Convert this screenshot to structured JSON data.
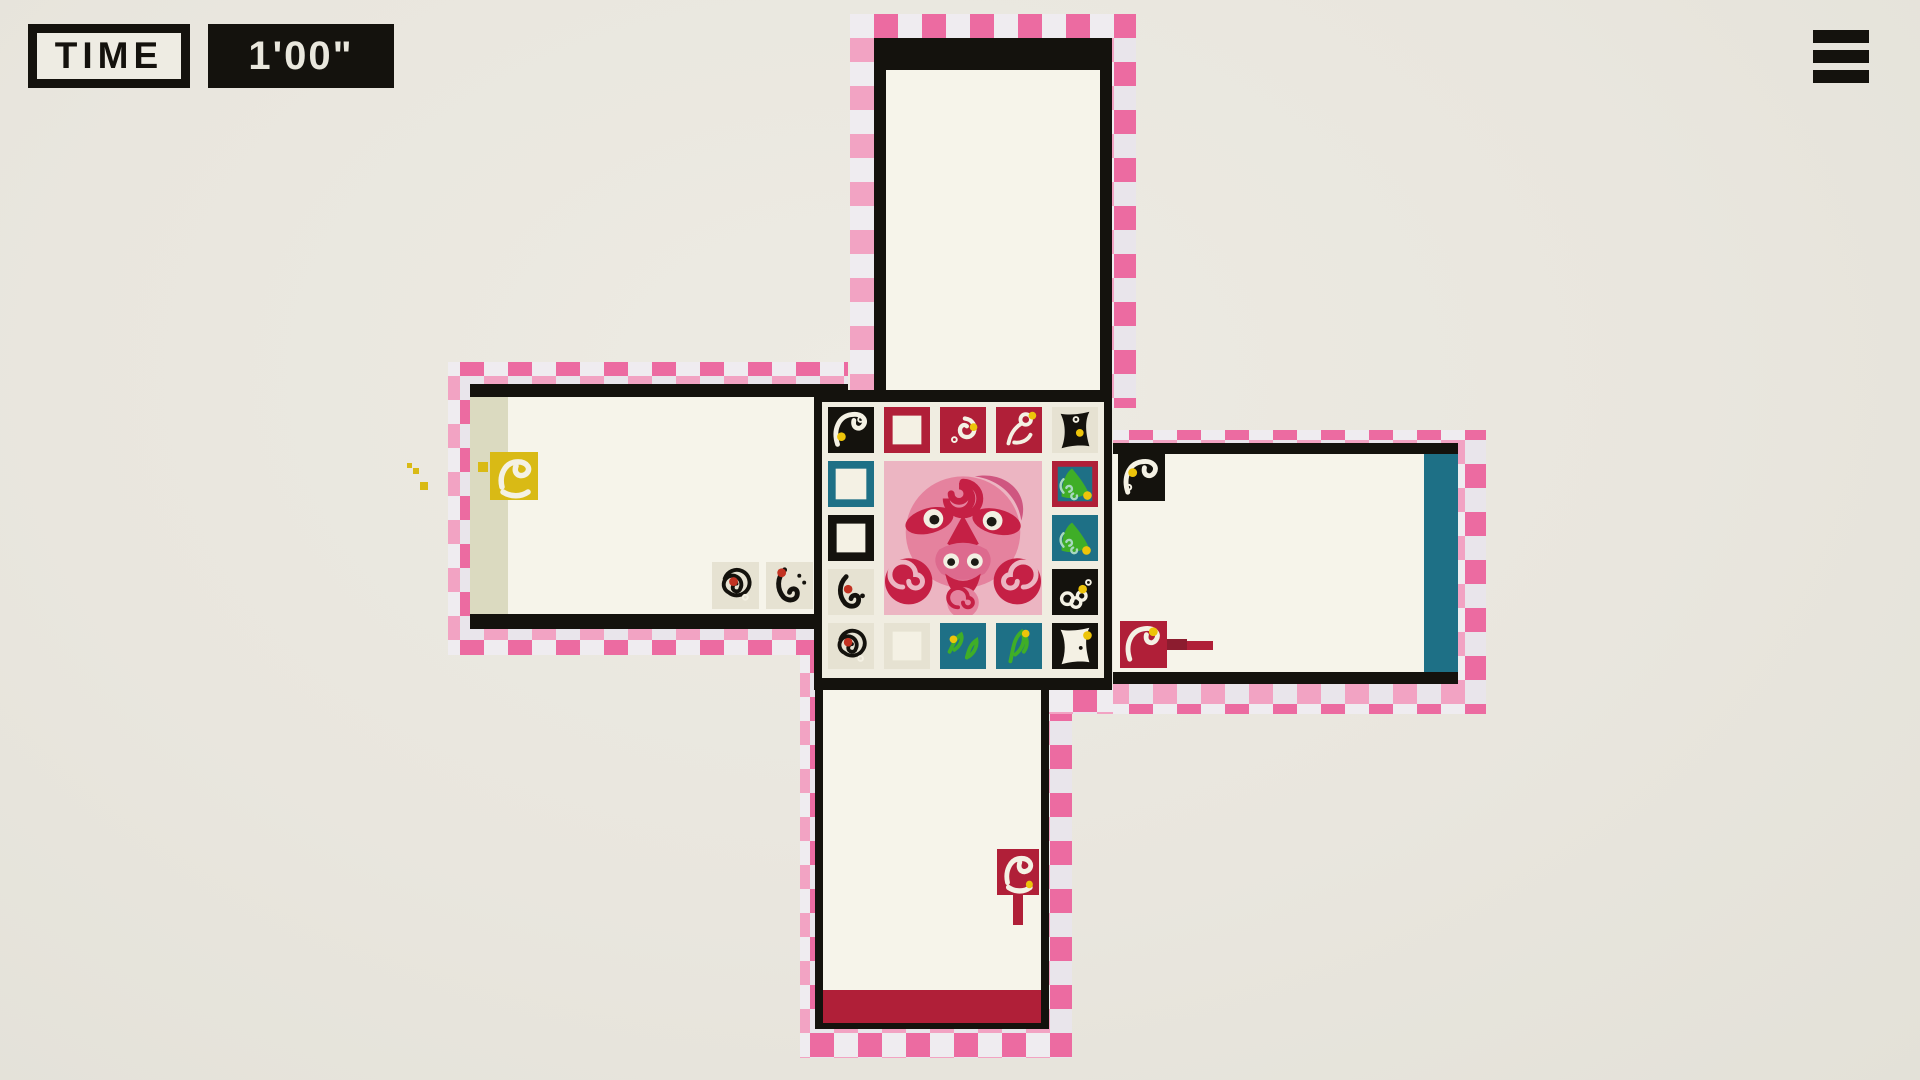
{
  "hud": {
    "time_label": "TIME",
    "time_value": "1'00\"",
    "menu_icon": "hamburger-icon"
  },
  "palette": {
    "black": "#14120d",
    "crimson": "#b01f38",
    "crimson_dark": "#8c1c2f",
    "teal": "#1e7086",
    "green": "#3fae27",
    "green_curl": "#a8d8c0",
    "yellow": "#edc40a",
    "duck_yellow": "#d9ba15",
    "cream": "#f6f4ea",
    "cream_tile": "#e6e2d2",
    "panel_cream": "#f0ede1",
    "white": "#f4f1e4",
    "red_dot": "#c23222",
    "pink_dark": "#ec6ba1",
    "pink_light": "#f2a3c3",
    "ribbon_light": "#e9e5eb",
    "face_pink": "#ecb5c2",
    "face_mid": "#e5829e",
    "face_deep": "#c52045",
    "beige_stripe": "#dbdac0"
  },
  "board": {
    "center_art": "pink-octopus-face",
    "tiles": [
      {
        "r": 1,
        "c": 1,
        "name": "tile-black-swan",
        "bg": "black",
        "glyph": "swan",
        "fg": "white",
        "dots": [
          {
            "x": 14,
            "y": 31,
            "rad": 4.5,
            "col": "yellow"
          },
          {
            "x": 34,
            "y": 13,
            "rad": 2.5,
            "col": "white",
            "ring": true
          }
        ]
      },
      {
        "r": 1,
        "c": 2,
        "name": "tile-red-frame",
        "bg": "crimson",
        "inner": "white",
        "inset": 9
      },
      {
        "r": 1,
        "c": 3,
        "name": "tile-red-comma",
        "bg": "crimson",
        "glyph": "comma",
        "fg": "white",
        "dots": [
          {
            "x": 35,
            "y": 21,
            "rad": 4,
            "col": "yellow"
          },
          {
            "x": 15,
            "y": 34,
            "rad": 2.5,
            "col": "white",
            "ring": true
          }
        ]
      },
      {
        "r": 1,
        "c": 4,
        "name": "tile-red-pin-bird",
        "bg": "crimson",
        "glyph": "pin",
        "fg": "white",
        "dots": [
          {
            "x": 38,
            "y": 9,
            "rad": 4,
            "col": "yellow"
          }
        ]
      },
      {
        "r": 1,
        "c": 5,
        "name": "tile-cream-black-wedge",
        "bg": "cream_tile",
        "glyph": "wedge",
        "fg": "black",
        "dots": [
          {
            "x": 29,
            "y": 27,
            "rad": 4,
            "col": "yellow"
          },
          {
            "x": 25,
            "y": 13,
            "rad": 2.5,
            "col": "white",
            "ring": true
          }
        ]
      },
      {
        "r": 2,
        "c": 1,
        "name": "tile-teal-frame",
        "bg": "teal",
        "inner": "white",
        "inset": 8
      },
      {
        "r": 3,
        "c": 1,
        "name": "tile-black-frame",
        "bg": "black",
        "inner": "white",
        "inset": 9
      },
      {
        "r": 4,
        "c": 1,
        "name": "tile-cream-hook-bird",
        "bg": "cream_tile",
        "glyph": "hook",
        "fg": "black",
        "dots": [
          {
            "x": 21,
            "y": 21,
            "rad": 4.5,
            "col": "red_dot"
          },
          {
            "x": 36,
            "y": 28,
            "rad": 2.5,
            "col": "black"
          }
        ]
      },
      {
        "r": 2,
        "c": 5,
        "name": "tile-red-teal-green-bird",
        "bg": "crimson",
        "inner": "teal",
        "inset": 6,
        "glyph": "leafbird",
        "fg": "green",
        "dots": [
          {
            "x": 37,
            "y": 36,
            "rad": 4.5,
            "col": "yellow"
          }
        ]
      },
      {
        "r": 3,
        "c": 5,
        "name": "tile-teal-green-bird",
        "bg": "teal",
        "glyph": "leafbird",
        "fg": "green",
        "dots": [
          {
            "x": 36,
            "y": 37,
            "rad": 4.5,
            "col": "yellow"
          }
        ]
      },
      {
        "r": 4,
        "c": 5,
        "name": "tile-black-ring-cluster",
        "bg": "black",
        "glyph": "flower",
        "fg": "white",
        "dots": [
          {
            "x": 32,
            "y": 21,
            "rad": 4.5,
            "col": "yellow"
          },
          {
            "x": 38,
            "y": 14,
            "rad": 2.5,
            "col": "white",
            "ring": true
          }
        ]
      },
      {
        "r": 5,
        "c": 1,
        "name": "tile-cream-spiral",
        "bg": "cream_tile",
        "glyph": "spiral",
        "fg": "black",
        "dots": [
          {
            "x": 21,
            "y": 20,
            "rad": 4.5,
            "col": "red_dot"
          },
          {
            "x": 34,
            "y": 37,
            "rad": 2.5,
            "col": "white",
            "ring": true
          }
        ]
      },
      {
        "r": 5,
        "c": 2,
        "name": "tile-cream-frame",
        "bg": "cream_tile",
        "inner": "white",
        "inset": 9
      },
      {
        "r": 5,
        "c": 3,
        "name": "tile-teal-two-sprigs",
        "bg": "teal",
        "glyph": "sprig2",
        "fg": "green",
        "dots": [
          {
            "x": 14,
            "y": 17,
            "rad": 4,
            "col": "yellow"
          }
        ]
      },
      {
        "r": 5,
        "c": 4,
        "name": "tile-teal-sprig",
        "bg": "teal",
        "glyph": "sprig",
        "fg": "green",
        "dots": [
          {
            "x": 31,
            "y": 11,
            "rad": 4,
            "col": "yellow"
          }
        ]
      },
      {
        "r": 5,
        "c": 5,
        "name": "tile-black-white-bird",
        "bg": "black",
        "glyph": "wedge",
        "fg": "white",
        "dots": [
          {
            "x": 37,
            "y": 13,
            "rad": 4.5,
            "col": "yellow"
          },
          {
            "x": 30,
            "y": 26,
            "rad": 2,
            "col": "black"
          }
        ]
      }
    ]
  },
  "entities": {
    "tiles": [
      {
        "name": "player-duck-yellow",
        "x": 490,
        "y": 452,
        "s": 48,
        "bg": "duck_yellow",
        "glyph": "duck",
        "fg": "white",
        "room": "left"
      },
      {
        "name": "pickup-spiral-red-dot",
        "x": 712,
        "y": 562,
        "s": 47,
        "bg": "cream_tile",
        "glyph": "spiral",
        "fg": "black",
        "dots": [
          {
            "x": 22,
            "y": 20,
            "rad": 4.5,
            "col": "red_dot"
          },
          {
            "x": 34,
            "y": 36,
            "rad": 2.5,
            "col": "white",
            "ring": true
          }
        ],
        "room": "left"
      },
      {
        "name": "pickup-hook-red-dot",
        "x": 766,
        "y": 562,
        "s": 47,
        "bg": "cream_tile",
        "glyph": "hook",
        "fg": "black",
        "dots": [
          {
            "x": 16,
            "y": 11,
            "rad": 4.5,
            "col": "red_dot"
          },
          {
            "x": 34,
            "y": 14,
            "rad": 2,
            "col": "black"
          },
          {
            "x": 39,
            "y": 21,
            "rad": 2,
            "col": "black"
          }
        ],
        "room": "left"
      },
      {
        "name": "enemy-black-swan",
        "x": 1118,
        "y": 454,
        "s": 47,
        "bg": "black",
        "glyph": "swan",
        "fg": "white",
        "dots": [
          {
            "x": 15,
            "y": 19,
            "rad": 4.5,
            "col": "yellow"
          },
          {
            "x": 11,
            "y": 34,
            "rad": 2.5,
            "col": "white",
            "ring": true
          }
        ],
        "room": "right"
      },
      {
        "name": "enemy-red-spear-duck",
        "x": 1120,
        "y": 621,
        "s": 47,
        "bg": "crimson",
        "glyph": "swan",
        "fg": "white",
        "dots": [
          {
            "x": 34,
            "y": 11,
            "rad": 4.5,
            "col": "yellow"
          }
        ],
        "room": "right"
      },
      {
        "name": "flag-red-duck",
        "x": 997,
        "y": 849,
        "s": 42,
        "h": 46,
        "bg": "crimson",
        "glyph": "duck",
        "fg": "white",
        "dots": [
          {
            "x": 37,
            "y": 37,
            "rad": 4,
            "col": "yellow"
          }
        ],
        "room": "bottom"
      }
    ],
    "rects": [
      {
        "name": "spear-bar-dark",
        "x": 1167,
        "y": 639,
        "w": 20,
        "h": 11,
        "col": "crimson_dark"
      },
      {
        "name": "spear-bar",
        "x": 1187,
        "y": 641,
        "w": 26,
        "h": 9,
        "col": "crimson"
      },
      {
        "name": "flag-stem",
        "x": 1013,
        "y": 895,
        "w": 10,
        "h": 30,
        "col": "crimson"
      },
      {
        "name": "duck-fragment",
        "x": 478,
        "y": 462,
        "w": 10,
        "h": 10,
        "col": "duck_yellow"
      },
      {
        "name": "speck-1",
        "x": 407,
        "y": 463,
        "w": 5,
        "h": 5,
        "col": "duck_yellow"
      },
      {
        "name": "speck-2",
        "x": 413,
        "y": 468,
        "w": 6,
        "h": 6,
        "col": "duck_yellow"
      },
      {
        "name": "speck-3",
        "x": 420,
        "y": 482,
        "w": 8,
        "h": 8,
        "col": "duck_yellow"
      }
    ]
  }
}
